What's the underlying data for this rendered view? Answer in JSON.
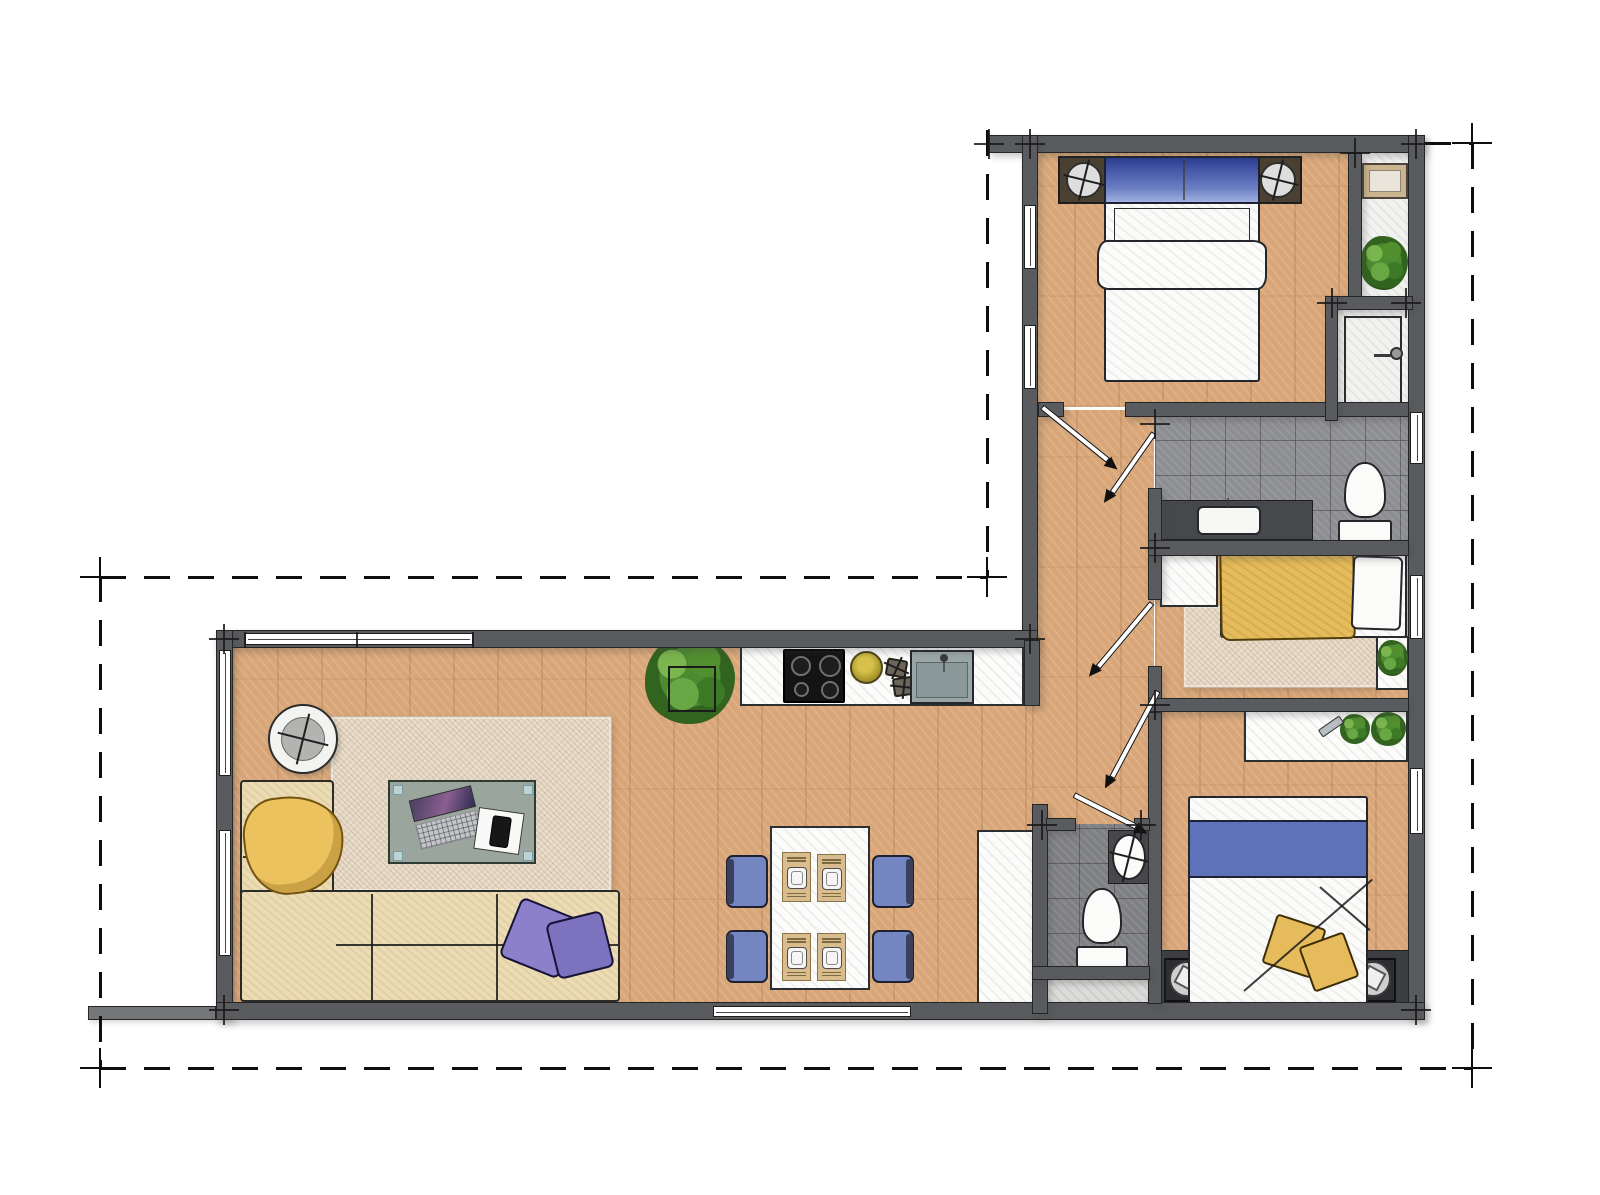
{
  "meta": {
    "type": "architectural-floor-plan",
    "canvas": {
      "w": 1600,
      "h": 1195
    },
    "colors": {
      "wall": "#595b5e",
      "wood": "#d8a678",
      "tile_gray": "#8d8e91",
      "tile_dark": "#7f8084",
      "accent_blue": "#5d72b8",
      "pillow_blue": "#2c3c92",
      "accent_yellow": "#e5bb5c",
      "accent_purple": "#8b80c9",
      "chair_blue": "#7486c2",
      "sofa_cream": "#ecdcb4",
      "rug_beige": "#e9dcca",
      "plant_green": "#568f33"
    },
    "rooms": [
      "living-room",
      "kitchen",
      "dining-area",
      "hallway",
      "master-bedroom",
      "closet-niche",
      "shower",
      "bathroom",
      "middle-bedroom",
      "wc",
      "rear-bedroom"
    ]
  },
  "items": [
    {
      "k": "floor",
      "c": "floor-wood",
      "n": "living-room-floor",
      "b": [
        233,
        640,
        800,
        370
      ]
    },
    {
      "k": "floor",
      "c": "floor-wood",
      "n": "master-bedroom-floor",
      "b": [
        1030,
        145,
        322,
        262
      ]
    },
    {
      "k": "floor",
      "c": "tile-white",
      "n": "closet-floor",
      "b": [
        1356,
        148,
        58,
        155
      ]
    },
    {
      "k": "floor",
      "c": "tile-white",
      "n": "shower-floor",
      "b": [
        1332,
        305,
        80,
        118
      ]
    },
    {
      "k": "floor",
      "c": "floor-wood",
      "n": "hallway-floor",
      "b": [
        1032,
        410,
        122,
        598
      ]
    },
    {
      "k": "floor",
      "c": "tile-gray",
      "n": "bathroom-floor",
      "b": [
        1155,
        412,
        258,
        134
      ]
    },
    {
      "k": "floor",
      "c": "floor-wood",
      "n": "middle-bedroom-floor",
      "b": [
        1155,
        550,
        258,
        154
      ]
    },
    {
      "k": "floor",
      "c": "floor-wood",
      "n": "rear-bedroom-floor",
      "b": [
        1155,
        706,
        258,
        300
      ]
    },
    {
      "k": "floor",
      "c": "tile-light",
      "n": "wc-niche-floor",
      "b": [
        1044,
        966,
        106,
        40
      ]
    },
    {
      "k": "floor",
      "c": "tile-gray dark",
      "n": "wc-floor",
      "b": [
        1044,
        824,
        106,
        145
      ]
    },
    {
      "k": "floor",
      "c": "rug",
      "n": "living-rug",
      "b": [
        330,
        716,
        282,
        176
      ]
    },
    {
      "k": "floor",
      "c": "rug",
      "n": "bedroom-rug",
      "b": [
        1183,
        605,
        197,
        83
      ]
    },
    {
      "k": "rtable",
      "n": "side-table",
      "b": [
        268,
        704,
        70,
        70
      ]
    },
    {
      "k": "rect",
      "c": "sofa",
      "n": "sofa-chaise",
      "b": [
        240,
        780,
        94,
        222
      ]
    },
    {
      "k": "rect",
      "c": "sofa",
      "n": "sofa-seat",
      "b": [
        240,
        890,
        380,
        112
      ]
    },
    {
      "k": "line",
      "n": "sofa-seam",
      "b": [
        336,
        944
      ],
      "l": 282,
      "a": 0
    },
    {
      "k": "line",
      "n": "sofa-seam",
      "b": [
        372,
        893
      ],
      "l": 106,
      "a": 90
    },
    {
      "k": "line",
      "n": "sofa-seam",
      "b": [
        497,
        893
      ],
      "l": 106,
      "a": 90
    },
    {
      "k": "line",
      "n": "sofa-seam",
      "b": [
        243,
        856
      ],
      "l": 90,
      "a": 0
    },
    {
      "k": "throw",
      "n": "throw-blanket",
      "b": [
        244,
        796,
        100,
        98
      ],
      "r": -6
    },
    {
      "k": "rect",
      "c": "cushion p1",
      "n": "sofa-cushion",
      "b": [
        508,
        906,
        64,
        64
      ],
      "r": 22
    },
    {
      "k": "rect",
      "c": "cushion p2",
      "n": "sofa-cushion",
      "b": [
        551,
        916,
        58,
        58
      ],
      "r": -14
    },
    {
      "k": "coffee",
      "n": "coffee-table",
      "b": [
        388,
        780,
        148,
        84
      ]
    },
    {
      "k": "rect",
      "c": "hatch-white",
      "n": "wardrobe-cabinet",
      "b": [
        977,
        830,
        58,
        174
      ]
    },
    {
      "k": "plant",
      "n": "potted-plant",
      "b": [
        645,
        636,
        90,
        88
      ]
    },
    {
      "k": "rect",
      "c": "planter",
      "n": "planter-box",
      "b": [
        668,
        666,
        48,
        46
      ]
    },
    {
      "k": "rect",
      "c": "hatch-white",
      "n": "kitchen-counter",
      "b": [
        740,
        644,
        284,
        62
      ]
    },
    {
      "k": "cook",
      "n": "cooktop",
      "b": [
        783,
        649,
        62,
        54
      ]
    },
    {
      "k": "bowl",
      "n": "fruit-bowl",
      "b": [
        850,
        651,
        33,
        33
      ]
    },
    {
      "k": "trivet",
      "n": "trivet",
      "b": [
        886,
        659,
        21,
        18
      ],
      "r": 10
    },
    {
      "k": "trivet",
      "n": "trivet",
      "b": [
        893,
        677,
        22,
        19
      ],
      "r": -8
    },
    {
      "k": "ksink",
      "n": "kitchen-sink",
      "b": [
        910,
        650,
        64,
        54
      ]
    },
    {
      "k": "rect",
      "c": "hatch-white",
      "n": "dining-table",
      "b": [
        770,
        826,
        100,
        164
      ]
    },
    {
      "k": "chair",
      "n": "dining-chair",
      "b": [
        726,
        855,
        42,
        53
      ],
      "s": "l"
    },
    {
      "k": "chair",
      "n": "dining-chair",
      "b": [
        726,
        930,
        42,
        53
      ],
      "s": "l"
    },
    {
      "k": "chair",
      "n": "dining-chair",
      "b": [
        872,
        855,
        42,
        53
      ],
      "s": "r"
    },
    {
      "k": "chair",
      "n": "dining-chair",
      "b": [
        872,
        930,
        42,
        53
      ],
      "s": "r"
    },
    {
      "k": "mat",
      "n": "place-setting",
      "b": [
        782,
        852,
        29,
        50
      ]
    },
    {
      "k": "mat",
      "n": "place-setting",
      "b": [
        817,
        854,
        29,
        48
      ]
    },
    {
      "k": "mat",
      "n": "place-setting",
      "b": [
        782,
        933,
        29,
        48
      ]
    },
    {
      "k": "mat",
      "n": "place-setting",
      "b": [
        817,
        933,
        29,
        48
      ]
    },
    {
      "k": "lamp",
      "n": "nightstand-lamp",
      "b": [
        1058,
        156,
        50,
        48
      ]
    },
    {
      "k": "lamp",
      "n": "nightstand-lamp",
      "b": [
        1252,
        156,
        50,
        48
      ]
    },
    {
      "k": "bedM",
      "n": "master-double-bed",
      "b": [
        1104,
        156,
        156,
        226
      ]
    },
    {
      "k": "pic",
      "n": "wall-mirror",
      "b": [
        1362,
        163,
        46,
        36
      ]
    },
    {
      "k": "plant",
      "n": "potted-plant",
      "b": [
        1360,
        236,
        48,
        54
      ]
    },
    {
      "k": "rect",
      "c": "inner-box",
      "n": "shower-tray",
      "b": [
        1344,
        316,
        58,
        96
      ]
    },
    {
      "k": "rect",
      "c": "shower-arm",
      "n": "shower-arm",
      "b": [
        1374,
        354,
        22,
        3
      ]
    },
    {
      "k": "rect",
      "c": "shower-head",
      "n": "shower-head",
      "b": [
        1390,
        347,
        13,
        13
      ]
    },
    {
      "k": "sinkc",
      "n": "bathroom-vanity",
      "b": [
        1160,
        500,
        153,
        40
      ]
    },
    {
      "k": "toilet",
      "n": "bathroom-toilet",
      "b": [
        1338,
        462,
        54,
        80
      ]
    },
    {
      "k": "rect",
      "c": "hatch-white",
      "n": "dresser",
      "b": [
        1160,
        553,
        58,
        54
      ]
    },
    {
      "k": "rect",
      "c": "bed-body",
      "n": "single-bed",
      "b": [
        1220,
        550,
        187,
        88
      ]
    },
    {
      "k": "rect",
      "c": "yellow-sketch",
      "n": "yellow-duvet",
      "b": [
        1220,
        549,
        135,
        91
      ],
      "r": -1
    },
    {
      "k": "rect",
      "c": "white-fixture pillow",
      "n": "bed-pillow",
      "b": [
        1352,
        556,
        50,
        74
      ],
      "r": 2
    },
    {
      "k": "rect",
      "c": "hatch-white",
      "n": "corner-shelf",
      "b": [
        1376,
        636,
        33,
        54
      ]
    },
    {
      "k": "plant",
      "n": "potted-plant",
      "b": [
        1377,
        640,
        31,
        36
      ]
    },
    {
      "k": "rect",
      "c": "hatch-white",
      "n": "console-shelf",
      "b": [
        1244,
        710,
        164,
        52
      ]
    },
    {
      "k": "plant",
      "n": "potted-plant",
      "b": [
        1340,
        714,
        30,
        30
      ]
    },
    {
      "k": "plant",
      "n": "potted-plant",
      "b": [
        1371,
        712,
        35,
        34
      ]
    },
    {
      "k": "rect",
      "c": "bottle",
      "n": "bottle",
      "b": [
        1318,
        722,
        26,
        9
      ],
      "r": -35
    },
    {
      "k": "rect",
      "c": "head-band",
      "n": "headboard-ledge",
      "b": [
        1155,
        950,
        258,
        56
      ]
    },
    {
      "k": "speaker",
      "n": "ceiling-spot",
      "b": [
        1164,
        958,
        46,
        44
      ]
    },
    {
      "k": "speaker",
      "n": "ceiling-spot",
      "b": [
        1350,
        958,
        46,
        44
      ]
    },
    {
      "k": "bedB",
      "n": "rear-double-bed",
      "b": [
        1188,
        796,
        180,
        208
      ]
    },
    {
      "k": "rect",
      "c": "ypillow",
      "n": "bed-cushion",
      "b": [
        1268,
        920,
        52,
        52
      ],
      "r": 18
    },
    {
      "k": "rect",
      "c": "ypillow",
      "n": "bed-cushion",
      "b": [
        1305,
        938,
        48,
        48
      ],
      "r": -20
    },
    {
      "k": "line",
      "n": "duvet-fold",
      "b": [
        1244,
        990
      ],
      "l": 170,
      "a": -41
    },
    {
      "k": "line",
      "n": "duvet-fold",
      "b": [
        1320,
        886
      ],
      "l": 66,
      "a": 41
    },
    {
      "k": "toilet",
      "n": "wc-toilet",
      "b": [
        1076,
        888,
        52,
        80
      ]
    },
    {
      "k": "rect",
      "c": "dark-fixture",
      "n": "wc-vanity",
      "b": [
        1108,
        830,
        42,
        54
      ]
    },
    {
      "k": "basin",
      "n": "wc-basin",
      "b": [
        1112,
        834,
        34,
        46
      ]
    },
    {
      "k": "wall",
      "n": "wall",
      "b": [
        988,
        135,
        437,
        18
      ]
    },
    {
      "k": "wall",
      "n": "wall",
      "b": [
        1408,
        135,
        17,
        884
      ]
    },
    {
      "k": "wall",
      "n": "wall",
      "b": [
        1022,
        135,
        16,
        505
      ]
    },
    {
      "k": "wall",
      "n": "wall",
      "b": [
        216,
        630,
        822,
        18
      ]
    },
    {
      "k": "wall",
      "n": "wall",
      "b": [
        216,
        630,
        17,
        390
      ]
    },
    {
      "k": "wall",
      "n": "wall",
      "b": [
        216,
        1002,
        1209,
        18
      ]
    },
    {
      "k": "wall",
      "c": "light",
      "n": "terrace-wall",
      "b": [
        88,
        1006,
        128,
        14
      ]
    },
    {
      "k": "wall",
      "n": "wall",
      "b": [
        1125,
        402,
        284,
        15
      ]
    },
    {
      "k": "wall",
      "n": "wall",
      "b": [
        1038,
        402,
        26,
        15
      ]
    },
    {
      "k": "wall",
      "n": "wall",
      "b": [
        1348,
        153,
        14,
        150
      ]
    },
    {
      "k": "wall",
      "n": "wall",
      "b": [
        1325,
        296,
        88,
        14
      ]
    },
    {
      "k": "wall",
      "n": "wall",
      "b": [
        1325,
        296,
        13,
        125
      ]
    },
    {
      "k": "wall",
      "n": "wall",
      "b": [
        1148,
        488,
        14,
        112
      ]
    },
    {
      "k": "wall",
      "n": "wall",
      "b": [
        1148,
        666,
        14,
        46
      ]
    },
    {
      "k": "wall",
      "n": "wall",
      "b": [
        1148,
        712,
        14,
        292
      ]
    },
    {
      "k": "wall",
      "n": "wall",
      "b": [
        1148,
        540,
        261,
        16
      ]
    },
    {
      "k": "wall",
      "n": "wall",
      "b": [
        1148,
        698,
        261,
        14
      ]
    },
    {
      "k": "wall",
      "n": "wall",
      "b": [
        1024,
        640,
        16,
        66
      ]
    },
    {
      "k": "wall",
      "n": "wall",
      "b": [
        1032,
        804,
        16,
        210
      ]
    },
    {
      "k": "wall",
      "n": "wall",
      "b": [
        1046,
        818,
        30,
        13
      ]
    },
    {
      "k": "wall",
      "n": "wall",
      "b": [
        1134,
        818,
        16,
        13
      ]
    },
    {
      "k": "wall",
      "n": "wall",
      "b": [
        1032,
        966,
        118,
        14
      ]
    },
    {
      "k": "window",
      "n": "window",
      "b": [
        1024,
        205,
        12,
        64
      ],
      "v": 1
    },
    {
      "k": "window",
      "n": "window",
      "b": [
        1024,
        325,
        12,
        64
      ],
      "v": 1
    },
    {
      "k": "window",
      "n": "window",
      "b": [
        245,
        633,
        228,
        12
      ]
    },
    {
      "k": "line",
      "n": "window-mullion",
      "b": [
        245,
        631
      ],
      "l": 16,
      "a": 90
    },
    {
      "k": "line",
      "n": "window-mullion",
      "b": [
        357,
        631
      ],
      "l": 16,
      "a": 90
    },
    {
      "k": "line",
      "n": "window-mullion",
      "b": [
        473,
        631
      ],
      "l": 16,
      "a": 90
    },
    {
      "k": "window",
      "n": "window",
      "b": [
        219,
        650,
        12,
        126
      ],
      "v": 1
    },
    {
      "k": "window",
      "n": "window",
      "b": [
        219,
        830,
        12,
        126
      ],
      "v": 1
    },
    {
      "k": "window",
      "n": "window",
      "b": [
        1410,
        412,
        13,
        52
      ],
      "v": 1
    },
    {
      "k": "window",
      "n": "window",
      "b": [
        1410,
        575,
        13,
        64
      ],
      "v": 1
    },
    {
      "k": "window",
      "n": "window",
      "b": [
        1410,
        768,
        13,
        66
      ],
      "v": 1
    },
    {
      "k": "window",
      "n": "entry-door-window",
      "b": [
        713,
        1006,
        198,
        11
      ]
    },
    {
      "k": "door",
      "n": "door-swing",
      "b": [
        1042,
        404
      ],
      "l": 85,
      "a": 39
    },
    {
      "k": "door",
      "n": "door-swing",
      "b": [
        1154,
        430
      ],
      "l": 73,
      "a": 125
    },
    {
      "k": "door",
      "n": "door-swing",
      "b": [
        1152,
        600
      ],
      "l": 84,
      "a": 130
    },
    {
      "k": "door",
      "n": "door-swing",
      "b": [
        1158,
        688
      ],
      "l": 98,
      "a": 118
    },
    {
      "k": "door",
      "n": "door-swing",
      "b": [
        1074,
        792
      ],
      "l": 70,
      "a": 27
    },
    {
      "k": "dash",
      "n": "boundary-line",
      "b": [
        100,
        576
      ],
      "l": 887,
      "o": "h"
    },
    {
      "k": "dash",
      "n": "boundary-line",
      "b": [
        99,
        576
      ],
      "l": 492,
      "o": "v"
    },
    {
      "k": "dash",
      "n": "boundary-line",
      "b": [
        100,
        1067
      ],
      "l": 1372,
      "o": "h"
    },
    {
      "k": "dash",
      "n": "boundary-line",
      "b": [
        1471,
        143
      ],
      "l": 925,
      "o": "v"
    },
    {
      "k": "dash",
      "n": "boundary-line",
      "b": [
        1425,
        142
      ],
      "l": 47,
      "o": "h"
    },
    {
      "k": "dash",
      "n": "boundary-line",
      "b": [
        986,
        130
      ],
      "l": 447,
      "o": "v"
    },
    {
      "k": "cross",
      "n": "datum-mark",
      "b": [
        100,
        577
      ]
    },
    {
      "k": "cross",
      "n": "datum-mark",
      "b": [
        100,
        1068
      ]
    },
    {
      "k": "cross",
      "n": "datum-mark",
      "b": [
        1472,
        1068
      ]
    },
    {
      "k": "cross",
      "n": "datum-mark",
      "b": [
        1472,
        143
      ]
    },
    {
      "k": "cross",
      "n": "datum-mark",
      "b": [
        987,
        577
      ]
    },
    {
      "k": "tick",
      "n": "corner-tick",
      "b": [
        989,
        144
      ]
    },
    {
      "k": "tick",
      "n": "corner-tick",
      "b": [
        1030,
        144
      ]
    },
    {
      "k": "tick",
      "n": "corner-tick",
      "b": [
        1416,
        144
      ]
    },
    {
      "k": "tick",
      "n": "corner-tick",
      "b": [
        224,
        639
      ]
    },
    {
      "k": "tick",
      "n": "corner-tick",
      "b": [
        1030,
        639
      ]
    },
    {
      "k": "tick",
      "n": "corner-tick",
      "b": [
        224,
        1010
      ]
    },
    {
      "k": "tick",
      "n": "corner-tick",
      "b": [
        1416,
        1010
      ]
    },
    {
      "k": "tick",
      "n": "corner-tick",
      "b": [
        1155,
        424
      ]
    },
    {
      "k": "tick",
      "n": "corner-tick",
      "b": [
        1155,
        548
      ]
    },
    {
      "k": "tick",
      "n": "corner-tick",
      "b": [
        1155,
        705
      ]
    },
    {
      "k": "tick",
      "n": "corner-tick",
      "b": [
        1042,
        825
      ]
    },
    {
      "k": "tick",
      "n": "corner-tick",
      "b": [
        1141,
        825
      ]
    },
    {
      "k": "tick",
      "n": "corner-tick",
      "b": [
        1355,
        153
      ]
    },
    {
      "k": "tick",
      "n": "corner-tick",
      "b": [
        1332,
        303
      ]
    },
    {
      "k": "tick",
      "n": "corner-tick",
      "b": [
        1406,
        303
      ]
    }
  ]
}
